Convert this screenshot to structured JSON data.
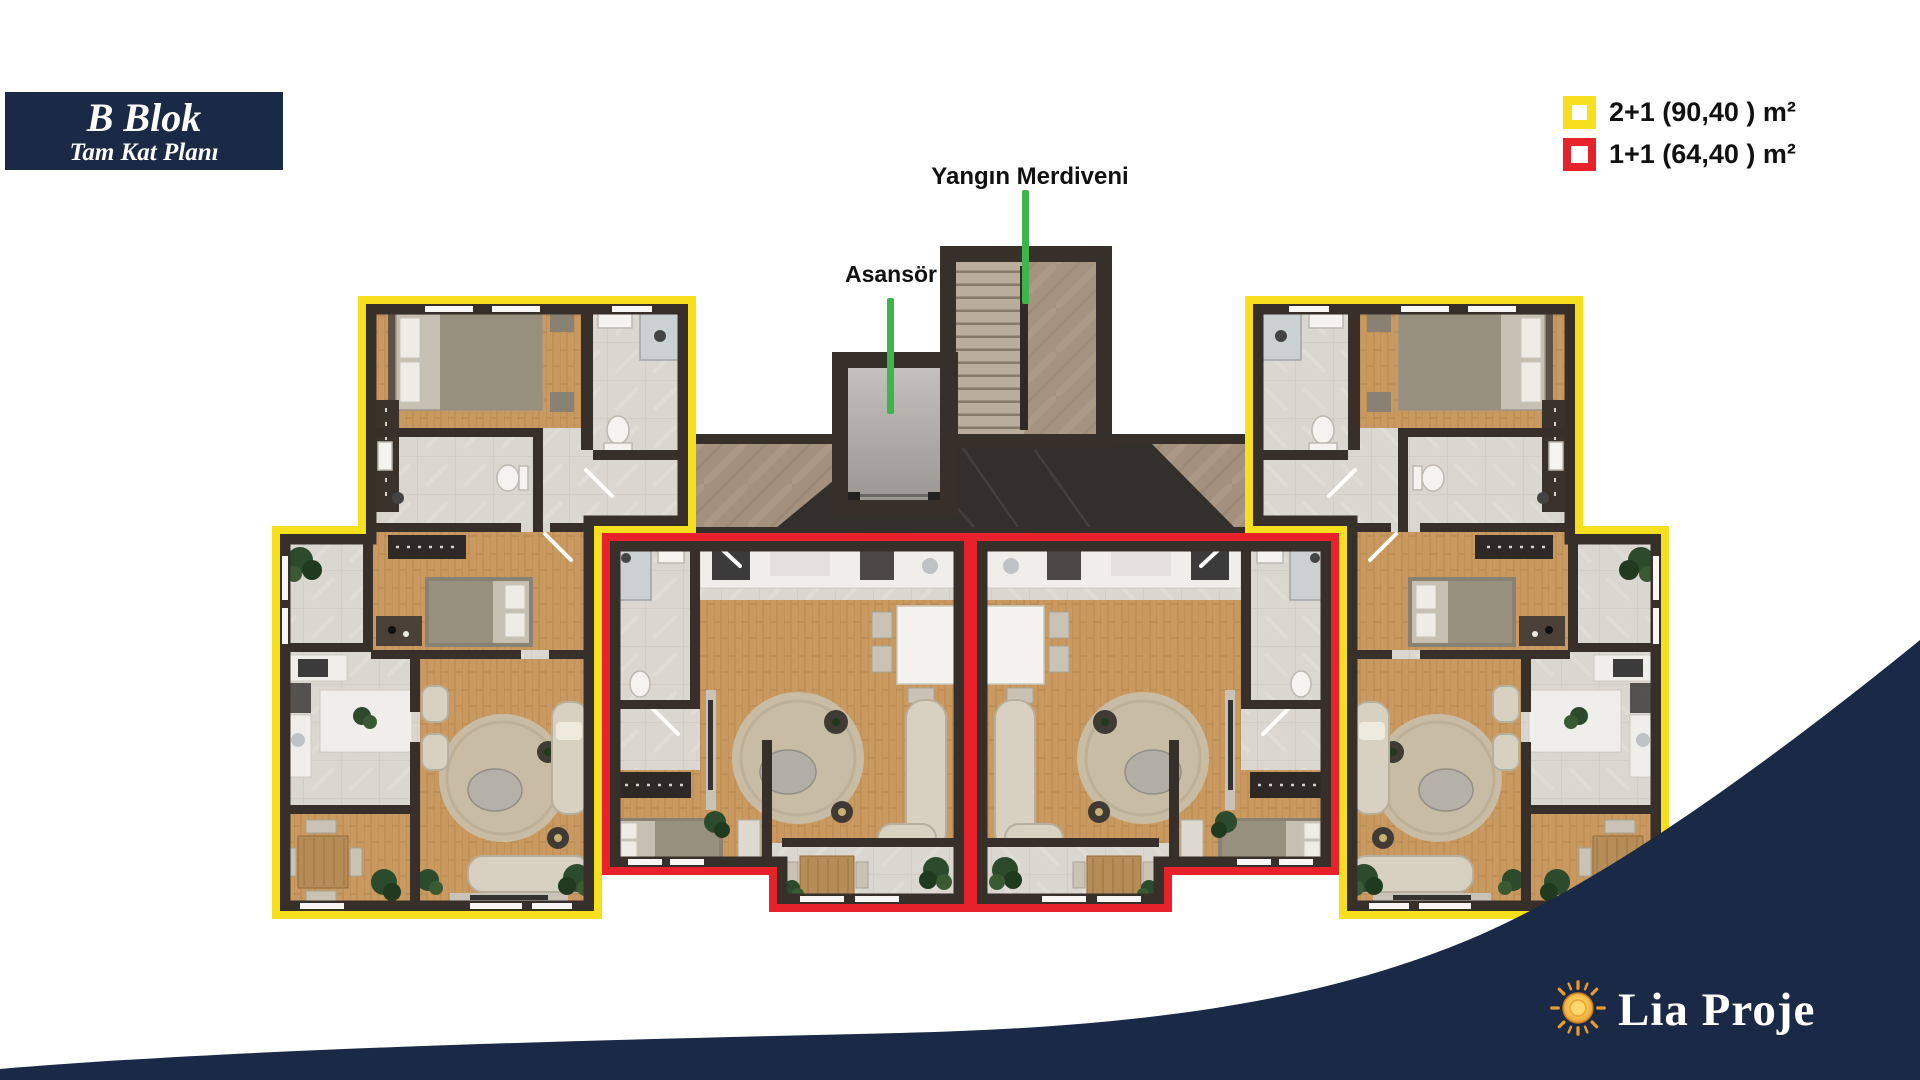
{
  "title_box": {
    "title": "B Blok",
    "subtitle": "Tam Kat Planı"
  },
  "legend": {
    "items": [
      {
        "id": "2plus1",
        "unit_type": "2+1",
        "area_m2": "90,40",
        "label": "2+1 (90,40 ) m²",
        "swatch_color": "#F6DF1C"
      },
      {
        "id": "1plus1",
        "unit_type": "1+1",
        "area_m2": "64,40",
        "label": "1+1 (64,40 ) m²",
        "swatch_color": "#E8222A"
      }
    ]
  },
  "callouts": {
    "elevator_label": "Asansör",
    "fire_escape_label": "Yangın Merdiveni",
    "pointer_color": "#3DB54A"
  },
  "brand": {
    "name": "Lia Proje",
    "sun_icon": "sun-icon"
  },
  "colors": {
    "navy": "#1A2945",
    "outline_2plus1": "#F6DF1C",
    "outline_1plus1": "#E8222A",
    "callout_green": "#3DB54A",
    "wall": "#37302A",
    "wood_floor": "#C9995F",
    "tile_floor": "#DAD6D0",
    "marble_floor": "#A3907D",
    "corridor_dark": "#332F2A",
    "label_text": "#111111",
    "brand_text": "#FFFFFF"
  }
}
